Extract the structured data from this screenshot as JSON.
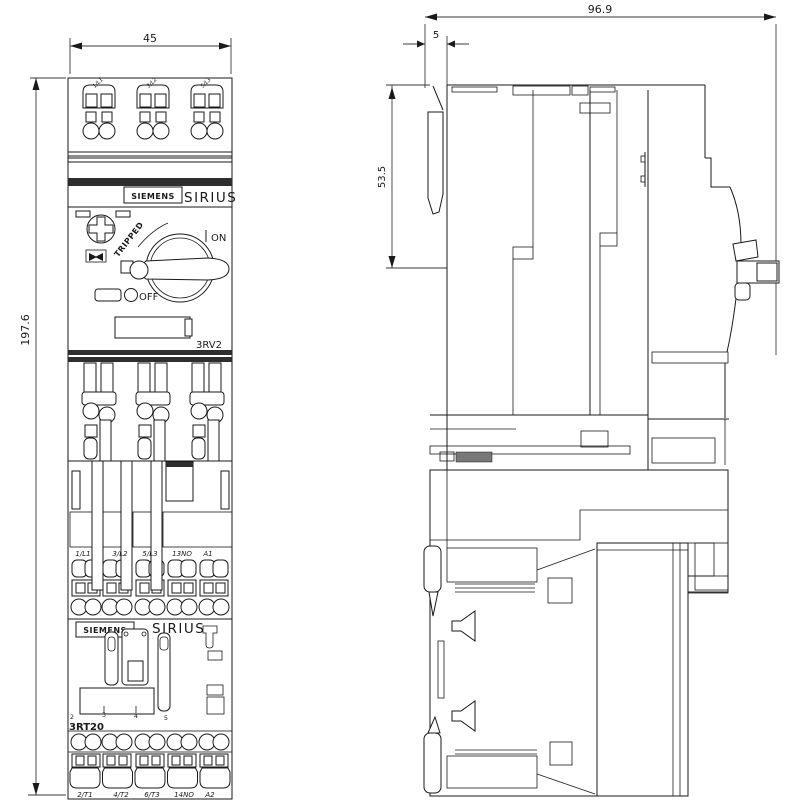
{
  "dims": {
    "width": "45",
    "height": "197.6",
    "depth": "96.9",
    "rail_offset": "5",
    "upper_depth": "53.5"
  },
  "breaker": {
    "brand": "SIEMENS",
    "series": "SIRIUS",
    "model": "3RV2",
    "on": "ON",
    "off": "OFF",
    "tripped": "TRIPPED",
    "top_terminals": [
      "1/L1",
      "3/L2",
      "5/L3"
    ]
  },
  "contactor": {
    "brand": "SIEMENS",
    "series": "SIRIUS",
    "model": "3RT20",
    "scale_marks": [
      "2",
      "3",
      "4",
      "5"
    ],
    "inputs": [
      "1/L1",
      "3/L2",
      "5/L3",
      "13NO",
      "A1"
    ],
    "outputs": [
      "2/T1",
      "4/T2",
      "6/T3",
      "14NO",
      "A2"
    ]
  },
  "colors": {
    "line": "#1a1a1a",
    "dimension": "#3a3a3a",
    "band": "#2e2e2e",
    "background": "#ffffff"
  }
}
